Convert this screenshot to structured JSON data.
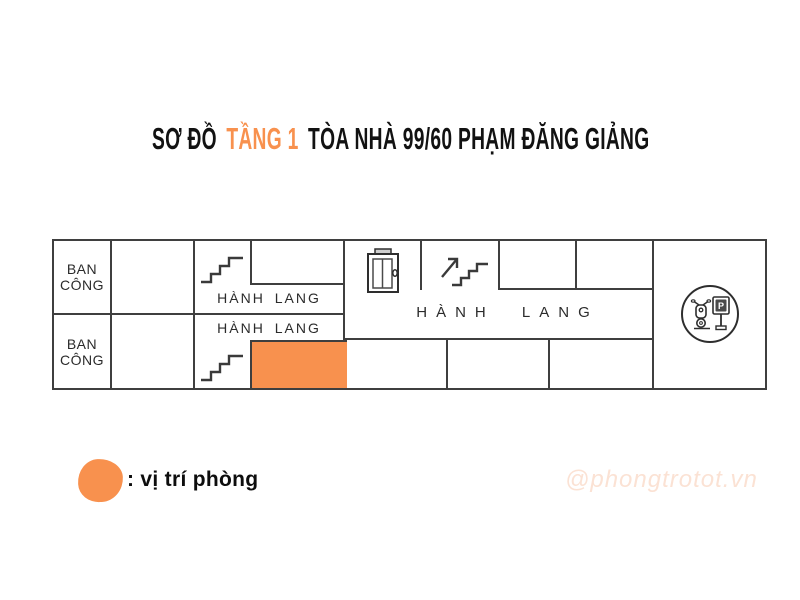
{
  "title": {
    "part1": "SƠ ĐỒ",
    "highlight": "TẦNG 1",
    "part2": "TÒA NHÀ 99/60 PHẠM ĐĂNG GIẢNG"
  },
  "plan": {
    "balcony_top": "BAN CÔNG",
    "balcony_bottom": "BAN CÔNG",
    "hallway_upper": "HÀNH LANG",
    "hallway_lower": "HÀNH LANG",
    "hallway_main": "HÀNH LANG",
    "parking_sign_letter": "P",
    "icons": {
      "stairs_upper": "staircase-icon",
      "stairs_lower": "staircase-icon",
      "stairs_up_arrow": "staircase-up-arrow-icon",
      "elevator": "elevator-door-icon",
      "parking": "motorbike-parking-icon"
    }
  },
  "legend": {
    "label": ": vị trí phòng",
    "swatch_meaning": "highlighted room location"
  },
  "watermark": {
    "text": "@phongtrotot.vn"
  },
  "colors": {
    "accent": "#F8914E",
    "wall": "#3F3F3F",
    "text": "#121212",
    "watermark": "#FBE2D4"
  }
}
